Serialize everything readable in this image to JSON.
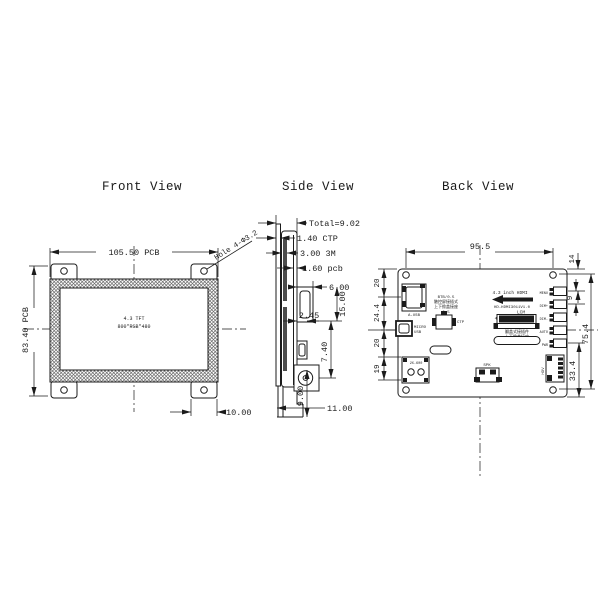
{
  "meta": {
    "background": "#ffffff",
    "ink": "#1b1b1b",
    "hatch": "#6a6a6a"
  },
  "front_view": {
    "title": "Front View",
    "screen_line1": "4.3 TFT",
    "screen_line2": "800*RGB*480",
    "dim_width": "105.50 PCB",
    "dim_height": "83.40 PCB",
    "dim_tab": "10.00",
    "hole_note": "Hole 4-Φ3.2"
  },
  "side_view": {
    "title": "Side View",
    "callout_total": "Total=9.02",
    "callout_ctp": "1.40 CTP",
    "callout_3m": "3.00 3M",
    "callout_pcb": "1.60 pcb",
    "dim_conn_depth": "6.00",
    "dim_conn_height": "15.00",
    "dim_usb_depth": "2.45",
    "dim_screw_height": "7.40",
    "dim_bottom_height": "9.00",
    "dim_total_depth": "11.00"
  },
  "back_view": {
    "title": "Back View",
    "dim_hole_span": "95.5",
    "dim_top_to_key": "14",
    "dim_key_pitch": "9",
    "dim_hole_height": "75.4",
    "dim_key_to_bottom": "33.4",
    "dim_left_1": "20",
    "dim_left_2": "24.4",
    "dim_left_3": "20",
    "dim_left_4": "19",
    "usb_label": "A-USB",
    "ctp_note_1": "BTB/0.5",
    "ctp_note_2": "触控屏接插式",
    "ctp_note_3": "上下掀盖接座",
    "ctp_note_4": "0.5",
    "ctp_label": "CTP",
    "micro_usb_1": "MICRO",
    "micro_usb_2": "USB",
    "power_label": "2X-600",
    "panel_title": "4.3 inch HDMI",
    "board_version": "HD-HDMI3011V1.0",
    "lcm_label": "LCM",
    "lcm_pin40": "40",
    "lcm_pin1": "1",
    "lcm_note_1": "翻盖式接插件",
    "lcm_note_2": "上下掀盖接座",
    "spk_label": "SPK",
    "hdv_label": "HDV",
    "keys": [
      "MENU",
      "DIM+",
      "DIM-",
      "AUTO",
      "PWR"
    ]
  }
}
